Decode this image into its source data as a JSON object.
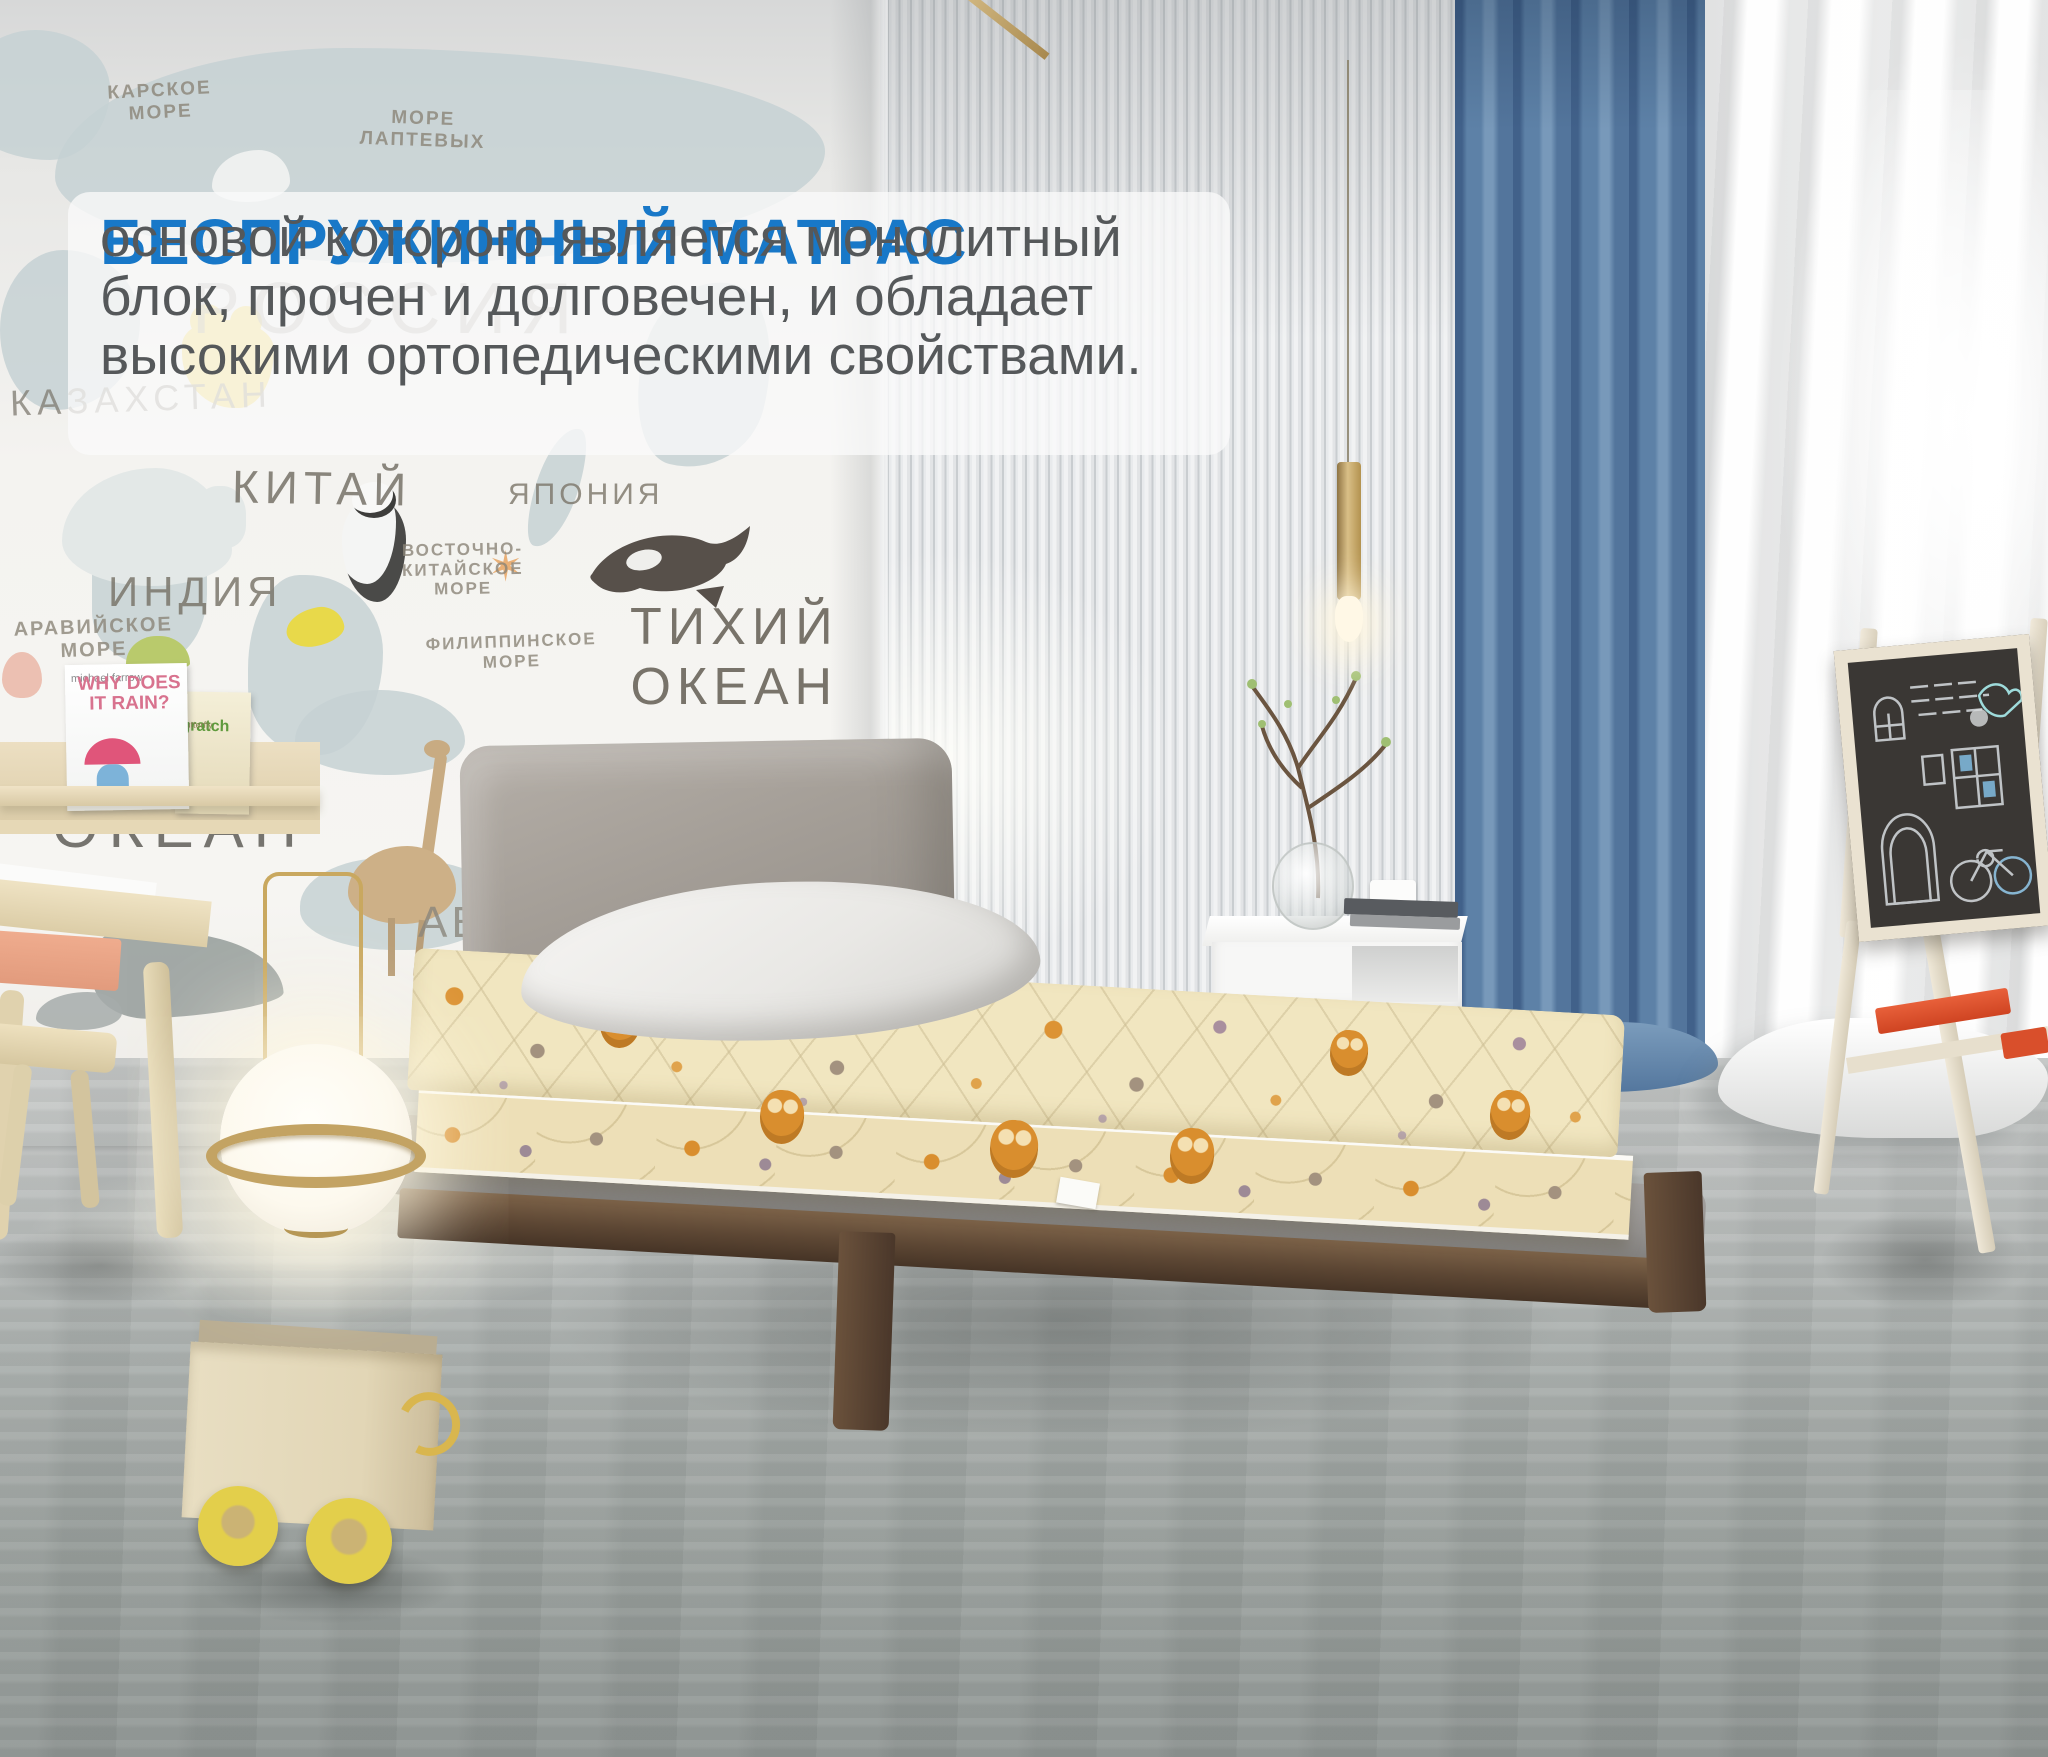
{
  "overlay_card": {
    "title": "БЕСПРУЖИННЫЙ МАТРАС",
    "body": "основой которого является монолитный\nблок, прочен и долговечен, и обладает\nвысокими ортопедическими свойствами.",
    "title_color": "#1878c8"
  },
  "wall_map": {
    "labels": {
      "kara_sea": "КАРСКОЕ\nМОРЕ",
      "laptev_sea": "МОРЕ\nЛАПТЕВЫХ",
      "russia": "РОССИЯ",
      "kazakhstan": "КАЗАХСТАН",
      "china": "КИТАЙ",
      "india": "ИНДИЯ",
      "japan": "ЯПОНИЯ",
      "arabian_sea": "АРАВИЙСКОЕ\nМОРЕ",
      "east_china_sea": "ВОСТОЧНО-\nКИТАЙСКОЕ\nМОРЕ",
      "philippine_sea": "ФИЛИППИНСКОЕ\nМОРЕ",
      "pacific_ocean": "ТИХИЙ\nОКЕАН",
      "indian_fragment": "ИНД",
      "ocean": "ОКЕАН",
      "abc": "ABC"
    },
    "star_glyph": "✶"
  },
  "bookshelf": {
    "book1_author": "michael farrow",
    "book1_title": "WHY DOES IT RAIN?",
    "book2_title": "gratch",
    "book2_subtitle": "butterfly"
  },
  "colors": {
    "accent_blue": "#1878c8",
    "curtain_blue": "#6287ab",
    "mattress_cream": "#f1e6c0",
    "owl_orange": "#d98e2e",
    "walnut_wood": "#5d4734",
    "brass_gold": "#c9a85f",
    "tray_red": "#d94f2b",
    "wheel_yellow": "#e3cf4b"
  }
}
